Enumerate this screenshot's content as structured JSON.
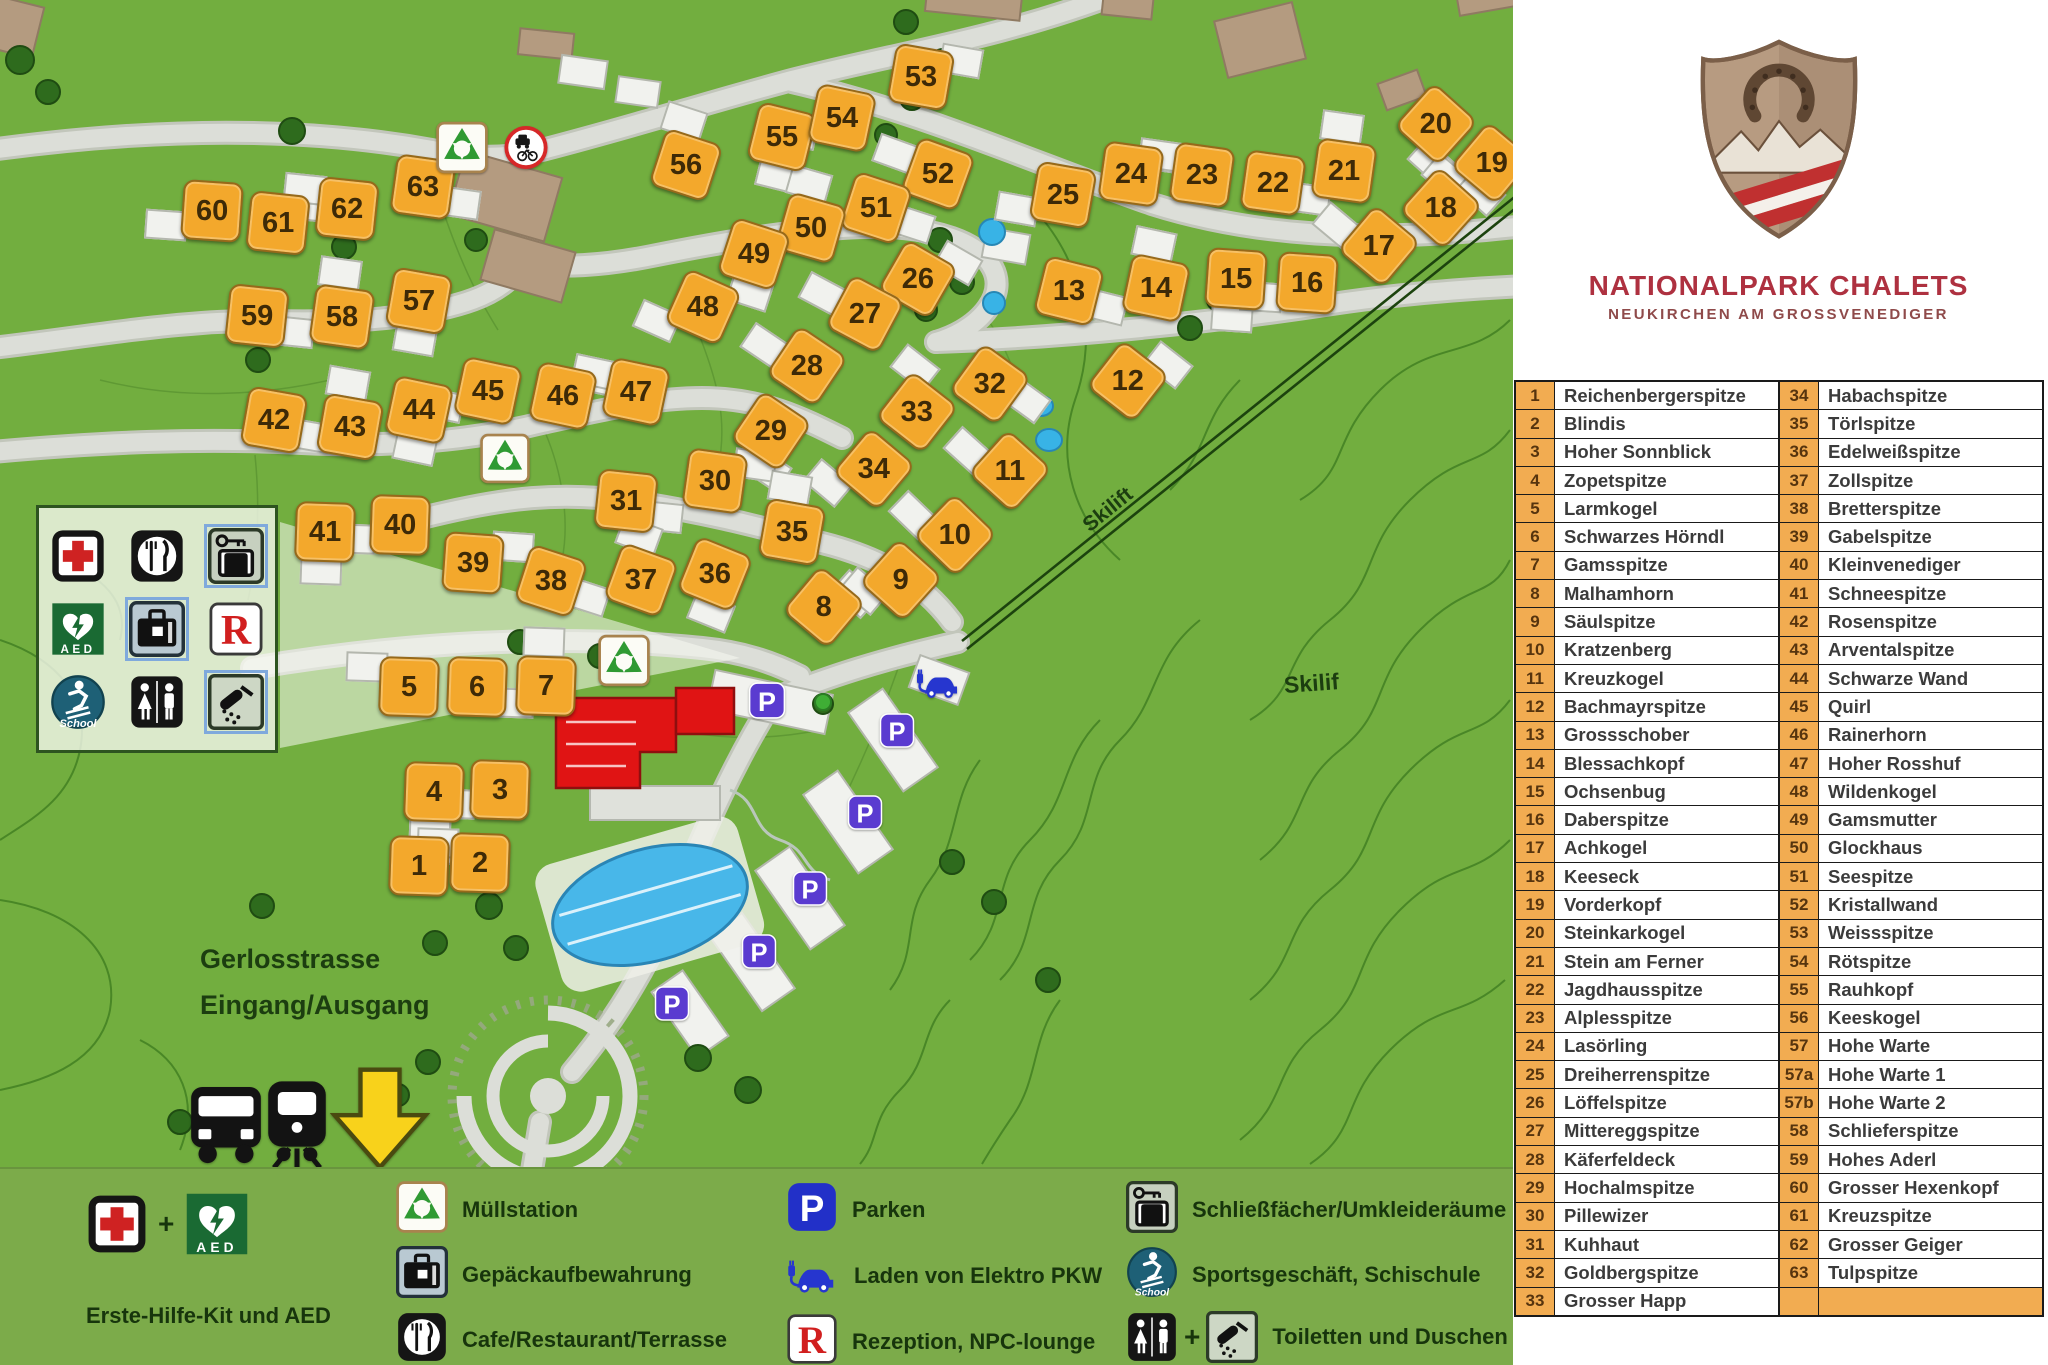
{
  "branding": {
    "title": "NATIONALPARK CHALETS",
    "subtitle": "NEUKIRCHEN AM GROSSVENEDIGER",
    "logo": "shield-horseshoe-mountains"
  },
  "directory": {
    "left": [
      {
        "num": "1",
        "name": "Reichenbergerspitze"
      },
      {
        "num": "2",
        "name": "Blindis"
      },
      {
        "num": "3",
        "name": "Hoher Sonnblick"
      },
      {
        "num": "4",
        "name": "Zopetspitze"
      },
      {
        "num": "5",
        "name": "Larmkogel"
      },
      {
        "num": "6",
        "name": "Schwarzes Hörndl"
      },
      {
        "num": "7",
        "name": "Gamsspitze"
      },
      {
        "num": "8",
        "name": "Malhamhorn"
      },
      {
        "num": "9",
        "name": "Säulspitze"
      },
      {
        "num": "10",
        "name": "Kratzenberg"
      },
      {
        "num": "11",
        "name": "Kreuzkogel"
      },
      {
        "num": "12",
        "name": "Bachmayrspitze"
      },
      {
        "num": "13",
        "name": "Grossschober"
      },
      {
        "num": "14",
        "name": "Blessachkopf"
      },
      {
        "num": "15",
        "name": "Ochsenbug"
      },
      {
        "num": "16",
        "name": "Daberspitze"
      },
      {
        "num": "17",
        "name": "Achkogel"
      },
      {
        "num": "18",
        "name": "Keeseck"
      },
      {
        "num": "19",
        "name": "Vorderkopf"
      },
      {
        "num": "20",
        "name": "Steinkarkogel"
      },
      {
        "num": "21",
        "name": "Stein am Ferner"
      },
      {
        "num": "22",
        "name": "Jagdhausspitze"
      },
      {
        "num": "23",
        "name": "Alplesspitze"
      },
      {
        "num": "24",
        "name": "Lasörling"
      },
      {
        "num": "25",
        "name": "Dreiherrenspitze"
      },
      {
        "num": "26",
        "name": "Löffelspitze"
      },
      {
        "num": "27",
        "name": "Mittereggspitze"
      },
      {
        "num": "28",
        "name": "Käferfeldeck"
      },
      {
        "num": "29",
        "name": "Hochalmspitze"
      },
      {
        "num": "30",
        "name": "Pillewizer"
      },
      {
        "num": "31",
        "name": "Kuhhaut"
      },
      {
        "num": "32",
        "name": "Goldbergspitze"
      },
      {
        "num": "33",
        "name": "Grosser Happ"
      }
    ],
    "right": [
      {
        "num": "34",
        "name": "Habachspitze"
      },
      {
        "num": "35",
        "name": "Törlspitze"
      },
      {
        "num": "36",
        "name": "Edelweißspitze"
      },
      {
        "num": "37",
        "name": "Zollspitze"
      },
      {
        "num": "38",
        "name": "Bretterspitze"
      },
      {
        "num": "39",
        "name": "Gabelspitze"
      },
      {
        "num": "40",
        "name": "Kleinvenediger"
      },
      {
        "num": "41",
        "name": "Schneespitze"
      },
      {
        "num": "42",
        "name": "Rosenspitze"
      },
      {
        "num": "43",
        "name": "Arventalspitze"
      },
      {
        "num": "44",
        "name": "Schwarze Wand"
      },
      {
        "num": "45",
        "name": "Quirl"
      },
      {
        "num": "46",
        "name": "Rainerhorn"
      },
      {
        "num": "47",
        "name": "Hoher Rosshuf"
      },
      {
        "num": "48",
        "name": "Wildenkogel"
      },
      {
        "num": "49",
        "name": "Gamsmutter"
      },
      {
        "num": "50",
        "name": "Glockhaus"
      },
      {
        "num": "51",
        "name": "Seespitze"
      },
      {
        "num": "52",
        "name": "Kristallwand"
      },
      {
        "num": "53",
        "name": "Weissspitze"
      },
      {
        "num": "54",
        "name": "Rötspitze"
      },
      {
        "num": "55",
        "name": "Rauhkopf"
      },
      {
        "num": "56",
        "name": "Keeskogel"
      },
      {
        "num": "57",
        "name": "Hohe Warte"
      },
      {
        "num": "57a",
        "name": "Hohe Warte 1"
      },
      {
        "num": "57b",
        "name": "Hohe Warte 2"
      },
      {
        "num": "58",
        "name": "Schlieferspitze"
      },
      {
        "num": "59",
        "name": "Hohes Aderl"
      },
      {
        "num": "60",
        "name": "Grosser Hexenkopf"
      },
      {
        "num": "61",
        "name": "Kreuzspitze"
      },
      {
        "num": "62",
        "name": "Grosser Geiger"
      },
      {
        "num": "63",
        "name": "Tulpspitze"
      },
      {
        "num": "",
        "name": ""
      }
    ]
  },
  "map": {
    "labels": [
      {
        "text": "Gerlosstrasse",
        "x": 200,
        "y": 944,
        "size": 27,
        "rot": 0
      },
      {
        "text": "Eingang/Ausgang",
        "x": 200,
        "y": 990,
        "size": 27,
        "rot": 0
      },
      {
        "text": "Skilift",
        "x": 1086,
        "y": 516,
        "size": 21,
        "rot": -39
      },
      {
        "text": "Skilif",
        "x": 1284,
        "y": 672,
        "size": 23,
        "rot": -4
      }
    ],
    "markers": [
      {
        "n": "60",
        "x": 210,
        "y": 209,
        "r": 4
      },
      {
        "n": "61",
        "x": 276,
        "y": 221,
        "r": 6
      },
      {
        "n": "62",
        "x": 345,
        "y": 207,
        "r": 6
      },
      {
        "n": "63",
        "x": 421,
        "y": 185,
        "r": 8
      },
      {
        "n": "56",
        "x": 684,
        "y": 163,
        "r": 18
      },
      {
        "n": "55",
        "x": 780,
        "y": 135,
        "r": 14
      },
      {
        "n": "54",
        "x": 840,
        "y": 116,
        "r": 12
      },
      {
        "n": "53",
        "x": 919,
        "y": 75,
        "r": 10
      },
      {
        "n": "52",
        "x": 936,
        "y": 172,
        "r": 20
      },
      {
        "n": "51",
        "x": 874,
        "y": 206,
        "r": 18
      },
      {
        "n": "50",
        "x": 809,
        "y": 226,
        "r": 16
      },
      {
        "n": "49",
        "x": 752,
        "y": 252,
        "r": 18
      },
      {
        "n": "25",
        "x": 1061,
        "y": 193,
        "r": 10
      },
      {
        "n": "24",
        "x": 1129,
        "y": 172,
        "r": 8
      },
      {
        "n": "23",
        "x": 1200,
        "y": 173,
        "r": 8
      },
      {
        "n": "22",
        "x": 1271,
        "y": 181,
        "r": 8
      },
      {
        "n": "21",
        "x": 1342,
        "y": 169,
        "r": 8
      },
      {
        "n": "20",
        "x": 1434,
        "y": 122,
        "r": 42
      },
      {
        "n": "19",
        "x": 1490,
        "y": 161,
        "r": 40
      },
      {
        "n": "18",
        "x": 1439,
        "y": 206,
        "r": 42
      },
      {
        "n": "17",
        "x": 1377,
        "y": 244,
        "r": 40
      },
      {
        "n": "59",
        "x": 255,
        "y": 314,
        "r": 6
      },
      {
        "n": "58",
        "x": 340,
        "y": 315,
        "r": 8
      },
      {
        "n": "57",
        "x": 417,
        "y": 299,
        "r": 10
      },
      {
        "n": "48",
        "x": 701,
        "y": 305,
        "r": 24
      },
      {
        "n": "26",
        "x": 916,
        "y": 277,
        "r": 30
      },
      {
        "n": "27",
        "x": 863,
        "y": 312,
        "r": 28
      },
      {
        "n": "13",
        "x": 1067,
        "y": 289,
        "r": 14
      },
      {
        "n": "14",
        "x": 1154,
        "y": 286,
        "r": 12
      },
      {
        "n": "15",
        "x": 1234,
        "y": 277,
        "r": 4
      },
      {
        "n": "16",
        "x": 1305,
        "y": 281,
        "r": 4
      },
      {
        "n": "12",
        "x": 1126,
        "y": 379,
        "r": 38
      },
      {
        "n": "28",
        "x": 805,
        "y": 364,
        "r": 34
      },
      {
        "n": "42",
        "x": 272,
        "y": 418,
        "r": 10
      },
      {
        "n": "43",
        "x": 348,
        "y": 425,
        "r": 10
      },
      {
        "n": "44",
        "x": 417,
        "y": 408,
        "r": 12
      },
      {
        "n": "45",
        "x": 486,
        "y": 389,
        "r": 12
      },
      {
        "n": "46",
        "x": 561,
        "y": 394,
        "r": 12
      },
      {
        "n": "47",
        "x": 634,
        "y": 390,
        "r": 12
      },
      {
        "n": "32",
        "x": 988,
        "y": 382,
        "r": 36
      },
      {
        "n": "33",
        "x": 915,
        "y": 410,
        "r": 38
      },
      {
        "n": "29",
        "x": 769,
        "y": 429,
        "r": 34
      },
      {
        "n": "34",
        "x": 872,
        "y": 467,
        "r": 40
      },
      {
        "n": "30",
        "x": 713,
        "y": 479,
        "r": 8
      },
      {
        "n": "11",
        "x": 1008,
        "y": 469,
        "r": 42
      },
      {
        "n": "31",
        "x": 624,
        "y": 499,
        "r": 6
      },
      {
        "n": "35",
        "x": 790,
        "y": 530,
        "r": 10
      },
      {
        "n": "41",
        "x": 323,
        "y": 530,
        "r": 2
      },
      {
        "n": "40",
        "x": 398,
        "y": 523,
        "r": 2
      },
      {
        "n": "39",
        "x": 471,
        "y": 561,
        "r": 4
      },
      {
        "n": "10",
        "x": 953,
        "y": 533,
        "r": 44
      },
      {
        "n": "38",
        "x": 549,
        "y": 579,
        "r": 18
      },
      {
        "n": "37",
        "x": 639,
        "y": 578,
        "r": 20
      },
      {
        "n": "36",
        "x": 713,
        "y": 572,
        "r": 22
      },
      {
        "n": "9",
        "x": 899,
        "y": 578,
        "r": 42
      },
      {
        "n": "8",
        "x": 822,
        "y": 605,
        "r": 40
      },
      {
        "n": "5",
        "x": 407,
        "y": 685,
        "r": 2
      },
      {
        "n": "6",
        "x": 475,
        "y": 685,
        "r": 2
      },
      {
        "n": "7",
        "x": 544,
        "y": 684,
        "r": 2
      },
      {
        "n": "4",
        "x": 432,
        "y": 790,
        "r": 2
      },
      {
        "n": "3",
        "x": 498,
        "y": 788,
        "r": 2
      },
      {
        "n": "1",
        "x": 417,
        "y": 864,
        "r": 2
      },
      {
        "n": "2",
        "x": 478,
        "y": 861,
        "r": 2
      }
    ],
    "facilities": [
      {
        "icon": "recycle",
        "x": 462,
        "y": 150,
        "s": 52
      },
      {
        "icon": "nosign",
        "x": 526,
        "y": 150,
        "s": 46
      },
      {
        "icon": "recycle",
        "x": 505,
        "y": 461,
        "s": 50
      },
      {
        "icon": "recycle",
        "x": 624,
        "y": 663,
        "s": 52
      },
      {
        "icon": "parking",
        "x": 767,
        "y": 703,
        "s": 38
      },
      {
        "icon": "parking",
        "x": 897,
        "y": 733,
        "s": 36
      },
      {
        "icon": "parking",
        "x": 865,
        "y": 815,
        "s": 36
      },
      {
        "icon": "parking",
        "x": 810,
        "y": 891,
        "s": 36
      },
      {
        "icon": "parking",
        "x": 759,
        "y": 954,
        "s": 36
      },
      {
        "icon": "parking",
        "x": 672,
        "y": 1006,
        "s": 36
      },
      {
        "icon": "ev",
        "x": 939,
        "y": 683,
        "s": 48
      },
      {
        "icon": "bus",
        "x": 226,
        "y": 1128,
        "s": 88
      },
      {
        "icon": "train",
        "x": 297,
        "y": 1128,
        "s": 92
      },
      {
        "icon": "arrow",
        "x": 380,
        "y": 1122,
        "s": 104
      }
    ],
    "facility_box": [
      [
        {
          "icon": "firstaid"
        },
        {
          "icon": "restaurant"
        },
        {
          "icon": "locker",
          "frame": "blue"
        }
      ],
      [
        {
          "icon": "aed"
        },
        {
          "icon": "luggage",
          "frame": "blue"
        },
        {
          "icon": "reception"
        }
      ],
      [
        {
          "icon": "school"
        },
        {
          "icon": "wc"
        },
        {
          "icon": "shower",
          "frame": "blue"
        }
      ]
    ]
  },
  "legend_bar": {
    "col1": {
      "icons": [
        "firstaid",
        "plus",
        "aed"
      ],
      "label": "Erste-Hilfe-Kit und AED"
    },
    "col2": [
      {
        "icon": "recycle",
        "label": "Müllstation"
      },
      {
        "icon": "luggage",
        "label": "Gepäckaufbewahrung"
      },
      {
        "icon": "restaurant",
        "label": "Cafe/Restaurant/Terrasse"
      }
    ],
    "col3": [
      {
        "icon": "parking",
        "label": "Parken"
      },
      {
        "icon": "ev",
        "label": "Laden von Elektro PKW"
      },
      {
        "icon": "reception",
        "label": "Rezeption, NPC-lounge"
      }
    ],
    "col4": [
      {
        "icon": "locker",
        "label": "Schließfächer/Umkleideräume"
      },
      {
        "icon": "school",
        "label": "Sportsgeschäft, Schischule"
      },
      {
        "icon": "wc+shower",
        "label": "Toiletten und Duschen"
      }
    ],
    "plus": "+"
  },
  "colors": {
    "map_green": "#72ae3f",
    "band_green": "#7cab4a",
    "marker_orange": "#f3a82c",
    "table_number_bg": "#f2ac51",
    "title_red": "#ae3140",
    "road_grey": "#dcded8",
    "water_blue": "#45b4e7",
    "reception_red": "#e01414",
    "map_parking": "#5a3bd0",
    "legend_parking": "#2230c8"
  }
}
